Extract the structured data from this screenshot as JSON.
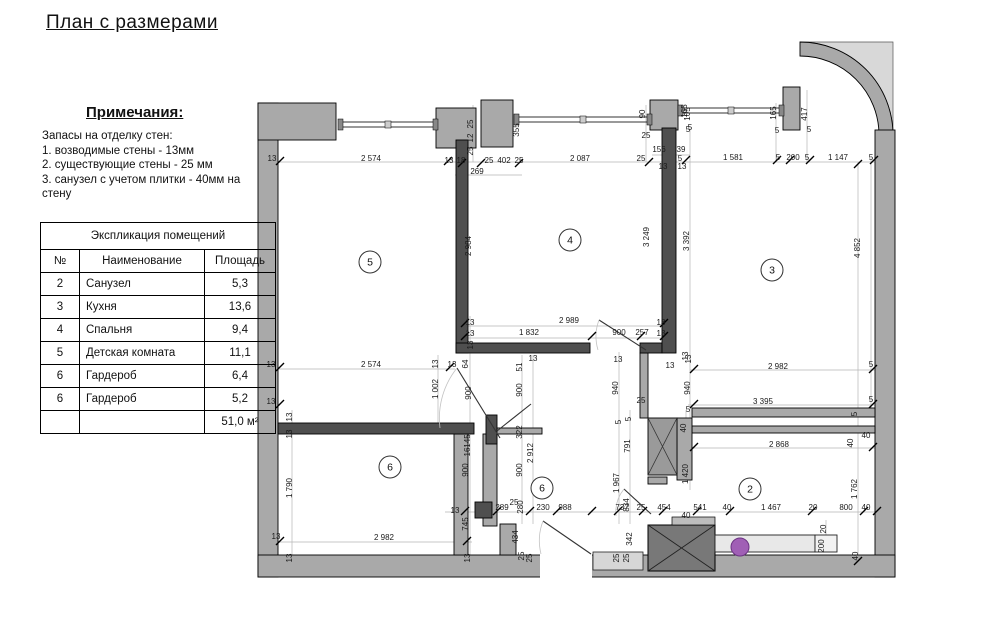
{
  "page": {
    "title": "План с размерами"
  },
  "notes": {
    "heading": "Примечания:",
    "intro": "Запасы на отделку стен:",
    "items": [
      "1. возводимые стены - 13мм",
      "2. существующие стены - 25 мм",
      "3. санузел с учетом плитки - 40мм на стену"
    ]
  },
  "table": {
    "title": "Экспликация помещений",
    "columns": [
      "№",
      "Наименование",
      "Площадь"
    ],
    "rows": [
      [
        "2",
        "Санузел",
        "5,3"
      ],
      [
        "3",
        "Кухня",
        "13,6"
      ],
      [
        "4",
        "Спальня",
        "9,4"
      ],
      [
        "5",
        "Детская комната",
        "11,1"
      ],
      [
        "6",
        "Гардероб",
        "6,4"
      ],
      [
        "6",
        "Гардероб",
        "5,2"
      ]
    ],
    "total": "51,0 м²"
  },
  "plan": {
    "colors": {
      "existing_wall": "#a9a9a9",
      "new_wall": "#4f4f4f",
      "shaft": "#787878",
      "fixture_accent": "#a05fb5"
    },
    "room_labels": [
      {
        "n": "5",
        "x": 370,
        "y": 262
      },
      {
        "n": "4",
        "x": 570,
        "y": 240
      },
      {
        "n": "3",
        "x": 772,
        "y": 270
      },
      {
        "n": "6",
        "x": 390,
        "y": 467
      },
      {
        "n": "6",
        "x": 542,
        "y": 488
      },
      {
        "n": "2",
        "x": 750,
        "y": 489
      }
    ],
    "dim_labels": [
      {
        "t": "13",
        "x": 272,
        "y": 161
      },
      {
        "t": "2 574",
        "x": 371,
        "y": 161
      },
      {
        "t": "13",
        "x": 449,
        "y": 163
      },
      {
        "t": "18",
        "x": 461,
        "y": 163
      },
      {
        "t": "25",
        "x": 489,
        "y": 163
      },
      {
        "t": "402",
        "x": 504,
        "y": 163
      },
      {
        "t": "25",
        "x": 519,
        "y": 163
      },
      {
        "t": "269",
        "x": 477,
        "y": 174
      },
      {
        "t": "2 087",
        "x": 580,
        "y": 161
      },
      {
        "t": "25",
        "x": 641,
        "y": 161
      },
      {
        "t": "156",
        "x": 659,
        "y": 152
      },
      {
        "t": "39",
        "x": 681,
        "y": 152
      },
      {
        "t": "5",
        "x": 680,
        "y": 161
      },
      {
        "t": "13",
        "x": 663,
        "y": 169
      },
      {
        "t": "13",
        "x": 682,
        "y": 169
      },
      {
        "t": "25",
        "x": 646,
        "y": 138
      },
      {
        "t": "90",
        "x": 645,
        "y": 114,
        "r": 1
      },
      {
        "t": "105",
        "x": 690,
        "y": 114,
        "r": 1
      },
      {
        "t": "5",
        "x": 690,
        "y": 130
      },
      {
        "t": "355",
        "x": 519,
        "y": 130,
        "r": 1
      },
      {
        "t": "25",
        "x": 473,
        "y": 124,
        "r": 1
      },
      {
        "t": "12",
        "x": 473,
        "y": 138,
        "r": 1
      },
      {
        "t": "25",
        "x": 473,
        "y": 151,
        "r": 1
      },
      {
        "t": "1 581",
        "x": 733,
        "y": 160
      },
      {
        "t": "5",
        "x": 778,
        "y": 160
      },
      {
        "t": "200",
        "x": 793,
        "y": 160
      },
      {
        "t": "5",
        "x": 807,
        "y": 160
      },
      {
        "t": "1 147",
        "x": 838,
        "y": 160
      },
      {
        "t": "5",
        "x": 871,
        "y": 160
      },
      {
        "t": "165",
        "x": 687,
        "y": 111,
        "r": 1
      },
      {
        "t": "5",
        "x": 688,
        "y": 132
      },
      {
        "t": "165",
        "x": 776,
        "y": 113,
        "r": 1
      },
      {
        "t": "5",
        "x": 777,
        "y": 133
      },
      {
        "t": "417",
        "x": 807,
        "y": 114,
        "r": 1
      },
      {
        "t": "5",
        "x": 809,
        "y": 132
      },
      {
        "t": "2 984",
        "x": 471,
        "y": 246,
        "r": 1
      },
      {
        "t": "3 249",
        "x": 649,
        "y": 237,
        "r": 1
      },
      {
        "t": "3 392",
        "x": 689,
        "y": 241,
        "r": 1
      },
      {
        "t": "4 852",
        "x": 860,
        "y": 248,
        "r": 1
      },
      {
        "t": "13",
        "x": 470,
        "y": 325
      },
      {
        "t": "2 989",
        "x": 569,
        "y": 323
      },
      {
        "t": "13",
        "x": 661,
        "y": 325
      },
      {
        "t": "13",
        "x": 470,
        "y": 336
      },
      {
        "t": "1 832",
        "x": 529,
        "y": 335
      },
      {
        "t": "900",
        "x": 619,
        "y": 335
      },
      {
        "t": "257",
        "x": 642,
        "y": 335
      },
      {
        "t": "13",
        "x": 661,
        "y": 336
      },
      {
        "t": "13",
        "x": 473,
        "y": 345,
        "r": 1
      },
      {
        "t": "13",
        "x": 271,
        "y": 367
      },
      {
        "t": "2 574",
        "x": 371,
        "y": 367
      },
      {
        "t": "13",
        "x": 438,
        "y": 364,
        "r": 1
      },
      {
        "t": "13",
        "x": 452,
        "y": 367
      },
      {
        "t": "64",
        "x": 468,
        "y": 364,
        "r": 1
      },
      {
        "t": "1 002",
        "x": 438,
        "y": 389,
        "r": 1
      },
      {
        "t": "900",
        "x": 471,
        "y": 393,
        "r": 1
      },
      {
        "t": "13",
        "x": 271,
        "y": 404
      },
      {
        "t": "13",
        "x": 292,
        "y": 417,
        "r": 1
      },
      {
        "t": "13",
        "x": 292,
        "y": 434,
        "r": 1
      },
      {
        "t": "145",
        "x": 470,
        "y": 441,
        "r": 1
      },
      {
        "t": "16",
        "x": 470,
        "y": 452,
        "r": 1
      },
      {
        "t": "900",
        "x": 468,
        "y": 470,
        "r": 1
      },
      {
        "t": "745",
        "x": 468,
        "y": 524,
        "r": 1
      },
      {
        "t": "13",
        "x": 455,
        "y": 513
      },
      {
        "t": "13",
        "x": 533,
        "y": 361
      },
      {
        "t": "51",
        "x": 522,
        "y": 367,
        "r": 1
      },
      {
        "t": "900",
        "x": 522,
        "y": 390,
        "r": 1
      },
      {
        "t": "322",
        "x": 522,
        "y": 432,
        "r": 1
      },
      {
        "t": "2 912",
        "x": 533,
        "y": 453,
        "r": 1
      },
      {
        "t": "900",
        "x": 522,
        "y": 470,
        "r": 1
      },
      {
        "t": "13",
        "x": 618,
        "y": 362
      },
      {
        "t": "940",
        "x": 618,
        "y": 388,
        "r": 1
      },
      {
        "t": "13",
        "x": 670,
        "y": 368
      },
      {
        "t": "13",
        "x": 691,
        "y": 359,
        "r": 1
      },
      {
        "t": "940",
        "x": 690,
        "y": 388,
        "r": 1
      },
      {
        "t": "25",
        "x": 641,
        "y": 403
      },
      {
        "t": "5",
        "x": 621,
        "y": 422,
        "r": 1
      },
      {
        "t": "5",
        "x": 631,
        "y": 419,
        "r": 1
      },
      {
        "t": "791",
        "x": 630,
        "y": 446,
        "r": 1
      },
      {
        "t": "1 967",
        "x": 619,
        "y": 483,
        "r": 1
      },
      {
        "t": "834",
        "x": 629,
        "y": 505,
        "r": 1
      },
      {
        "t": "342",
        "x": 632,
        "y": 539,
        "r": 1
      },
      {
        "t": "5",
        "x": 688,
        "y": 412
      },
      {
        "t": "40",
        "x": 686,
        "y": 428,
        "r": 1
      },
      {
        "t": "1 420",
        "x": 688,
        "y": 474,
        "r": 1
      },
      {
        "t": "40",
        "x": 686,
        "y": 518
      },
      {
        "t": "13",
        "x": 688,
        "y": 356,
        "r": 1
      },
      {
        "t": "2 982",
        "x": 778,
        "y": 369
      },
      {
        "t": "5",
        "x": 871,
        "y": 367
      },
      {
        "t": "3 395",
        "x": 763,
        "y": 404
      },
      {
        "t": "5",
        "x": 871,
        "y": 402
      },
      {
        "t": "5",
        "x": 857,
        "y": 414,
        "r": 1
      },
      {
        "t": "2 868",
        "x": 779,
        "y": 447
      },
      {
        "t": "40",
        "x": 853,
        "y": 443,
        "r": 1
      },
      {
        "t": "40",
        "x": 866,
        "y": 438
      },
      {
        "t": "1 762",
        "x": 857,
        "y": 489,
        "r": 1
      },
      {
        "t": "541",
        "x": 700,
        "y": 510
      },
      {
        "t": "40",
        "x": 727,
        "y": 510
      },
      {
        "t": "1 467",
        "x": 771,
        "y": 510
      },
      {
        "t": "20",
        "x": 813,
        "y": 510
      },
      {
        "t": "800",
        "x": 846,
        "y": 510
      },
      {
        "t": "40",
        "x": 866,
        "y": 510
      },
      {
        "t": "20",
        "x": 826,
        "y": 529,
        "r": 1
      },
      {
        "t": "200",
        "x": 824,
        "y": 546,
        "r": 1
      },
      {
        "t": "40",
        "x": 858,
        "y": 556,
        "r": 1
      },
      {
        "t": "289",
        "x": 502,
        "y": 510
      },
      {
        "t": "25",
        "x": 514,
        "y": 505
      },
      {
        "t": "280",
        "x": 523,
        "y": 507,
        "r": 1
      },
      {
        "t": "230",
        "x": 543,
        "y": 510
      },
      {
        "t": "988",
        "x": 565,
        "y": 510
      },
      {
        "t": "737",
        "x": 622,
        "y": 510
      },
      {
        "t": "25",
        "x": 641,
        "y": 510
      },
      {
        "t": "454",
        "x": 664,
        "y": 510
      },
      {
        "t": "434",
        "x": 518,
        "y": 537,
        "r": 1
      },
      {
        "t": "25",
        "x": 524,
        "y": 556,
        "r": 1
      },
      {
        "t": "25",
        "x": 532,
        "y": 558,
        "r": 1
      },
      {
        "t": "25",
        "x": 619,
        "y": 558,
        "r": 1
      },
      {
        "t": "25",
        "x": 629,
        "y": 558,
        "r": 1
      },
      {
        "t": "1 790",
        "x": 292,
        "y": 488,
        "r": 1
      },
      {
        "t": "13",
        "x": 276,
        "y": 539
      },
      {
        "t": "2 982",
        "x": 384,
        "y": 540
      },
      {
        "t": "13",
        "x": 292,
        "y": 558,
        "r": 1
      },
      {
        "t": "13",
        "x": 470,
        "y": 558,
        "r": 1
      }
    ]
  }
}
